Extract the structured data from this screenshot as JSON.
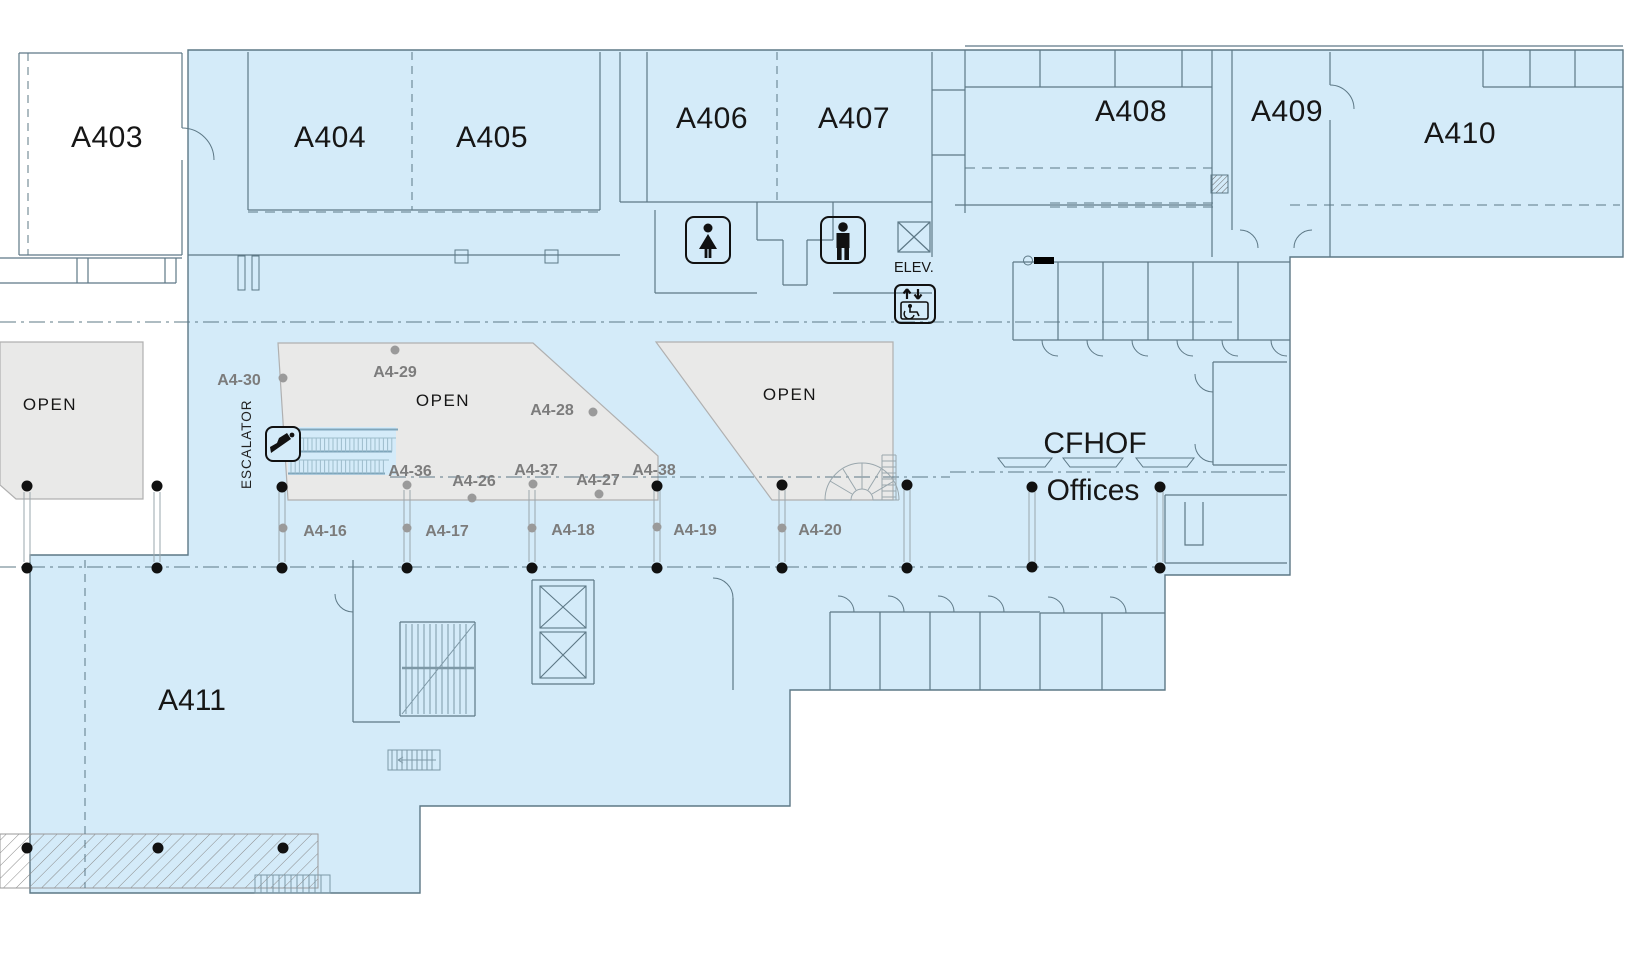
{
  "plan_title": "Level 4 concourse floor plan",
  "colors": {
    "floor_fill": "#d4ebf9",
    "open_area_fill": "#e9e9e8",
    "wall": "#5d7886",
    "open_area_stroke": "#b0b0b0",
    "label_text": "#161616",
    "column_label_text": "#7c7c7c",
    "black_dot": "#111111",
    "gray_dot": "#9a9a9a",
    "escalator_rail": "#7fa6bb"
  },
  "rooms": [
    {
      "label": "A403",
      "x": 107,
      "y": 137
    },
    {
      "label": "A404",
      "x": 330,
      "y": 137
    },
    {
      "label": "A405",
      "x": 492,
      "y": 137
    },
    {
      "label": "A406",
      "x": 712,
      "y": 118
    },
    {
      "label": "A407",
      "x": 854,
      "y": 118
    },
    {
      "label": "A408",
      "x": 1131,
      "y": 111
    },
    {
      "label": "A409",
      "x": 1287,
      "y": 111
    },
    {
      "label": "A410",
      "x": 1460,
      "y": 133
    },
    {
      "label": "A411",
      "x": 192,
      "y": 700
    }
  ],
  "open_labels": [
    {
      "label": "OPEN",
      "x": 50,
      "y": 404
    },
    {
      "label": "OPEN",
      "x": 443,
      "y": 400
    },
    {
      "label": "OPEN",
      "x": 790,
      "y": 394
    }
  ],
  "cfhof": {
    "line1": "CFHOF",
    "x1": 1095,
    "y1": 443,
    "line2": "Offices",
    "x2": 1093,
    "y2": 490
  },
  "wayfinding": {
    "escalator_label": {
      "text": "ESCALATOR",
      "x": 251,
      "y": 489
    },
    "elevator_label": {
      "text": "ELEV.",
      "x": 894,
      "y": 272
    }
  },
  "column_labels": [
    {
      "label": "A4-30",
      "x": 239,
      "y": 385
    },
    {
      "label": "A4-29",
      "x": 395,
      "y": 377
    },
    {
      "label": "A4-28",
      "x": 552,
      "y": 415
    },
    {
      "label": "A4-36",
      "x": 410,
      "y": 476
    },
    {
      "label": "A4-26",
      "x": 474,
      "y": 486
    },
    {
      "label": "A4-37",
      "x": 536,
      "y": 475
    },
    {
      "label": "A4-27",
      "x": 598,
      "y": 485
    },
    {
      "label": "A4-38",
      "x": 654,
      "y": 475
    },
    {
      "label": "A4-16",
      "x": 325,
      "y": 536
    },
    {
      "label": "A4-17",
      "x": 447,
      "y": 536
    },
    {
      "label": "A4-18",
      "x": 573,
      "y": 535
    },
    {
      "label": "A4-19",
      "x": 695,
      "y": 535
    },
    {
      "label": "A4-20",
      "x": 820,
      "y": 535
    }
  ],
  "columns": [
    {
      "x": 27,
      "y1": 492,
      "y2": 562
    },
    {
      "x": 157,
      "y1": 492,
      "y2": 562
    },
    {
      "x": 282,
      "y1": 492,
      "y2": 562
    },
    {
      "x": 407,
      "y1": 490,
      "y2": 562
    },
    {
      "x": 532,
      "y1": 490,
      "y2": 562
    },
    {
      "x": 657,
      "y1": 490,
      "y2": 562
    },
    {
      "x": 782,
      "y1": 490,
      "y2": 562
    },
    {
      "x": 907,
      "y1": 490,
      "y2": 562
    },
    {
      "x": 1032,
      "y1": 492,
      "y2": 562
    },
    {
      "x": 1160,
      "y1": 492,
      "y2": 562
    }
  ],
  "dots": {
    "black": [
      [
        27,
        486
      ],
      [
        157,
        486
      ],
      [
        282,
        487
      ],
      [
        657,
        486
      ],
      [
        782,
        485
      ],
      [
        907,
        485
      ],
      [
        1032,
        487
      ],
      [
        1160,
        487
      ],
      [
        27,
        568
      ],
      [
        157,
        568
      ],
      [
        282,
        568
      ],
      [
        407,
        568
      ],
      [
        532,
        568
      ],
      [
        657,
        568
      ],
      [
        782,
        568
      ],
      [
        907,
        568
      ],
      [
        1032,
        567
      ],
      [
        1160,
        568
      ],
      [
        27,
        848
      ],
      [
        158,
        848
      ],
      [
        283,
        848
      ]
    ],
    "gray": [
      [
        283,
        378
      ],
      [
        395,
        350
      ],
      [
        593,
        412
      ],
      [
        407,
        485
      ],
      [
        533,
        484
      ],
      [
        472,
        498
      ],
      [
        599,
        494
      ],
      [
        283,
        528
      ],
      [
        407,
        528
      ],
      [
        532,
        528
      ],
      [
        657,
        527
      ],
      [
        782,
        528
      ]
    ]
  },
  "icons": [
    {
      "name": "womens-restroom-icon",
      "x": 708,
      "y": 240
    },
    {
      "name": "mens-restroom-icon",
      "x": 843,
      "y": 240
    },
    {
      "name": "elevator-shaft-icon",
      "x": 914,
      "y": 237
    },
    {
      "name": "accessible-elevator-icon",
      "x": 915,
      "y": 304
    },
    {
      "name": "escalator-icon",
      "x": 283,
      "y": 444
    }
  ]
}
